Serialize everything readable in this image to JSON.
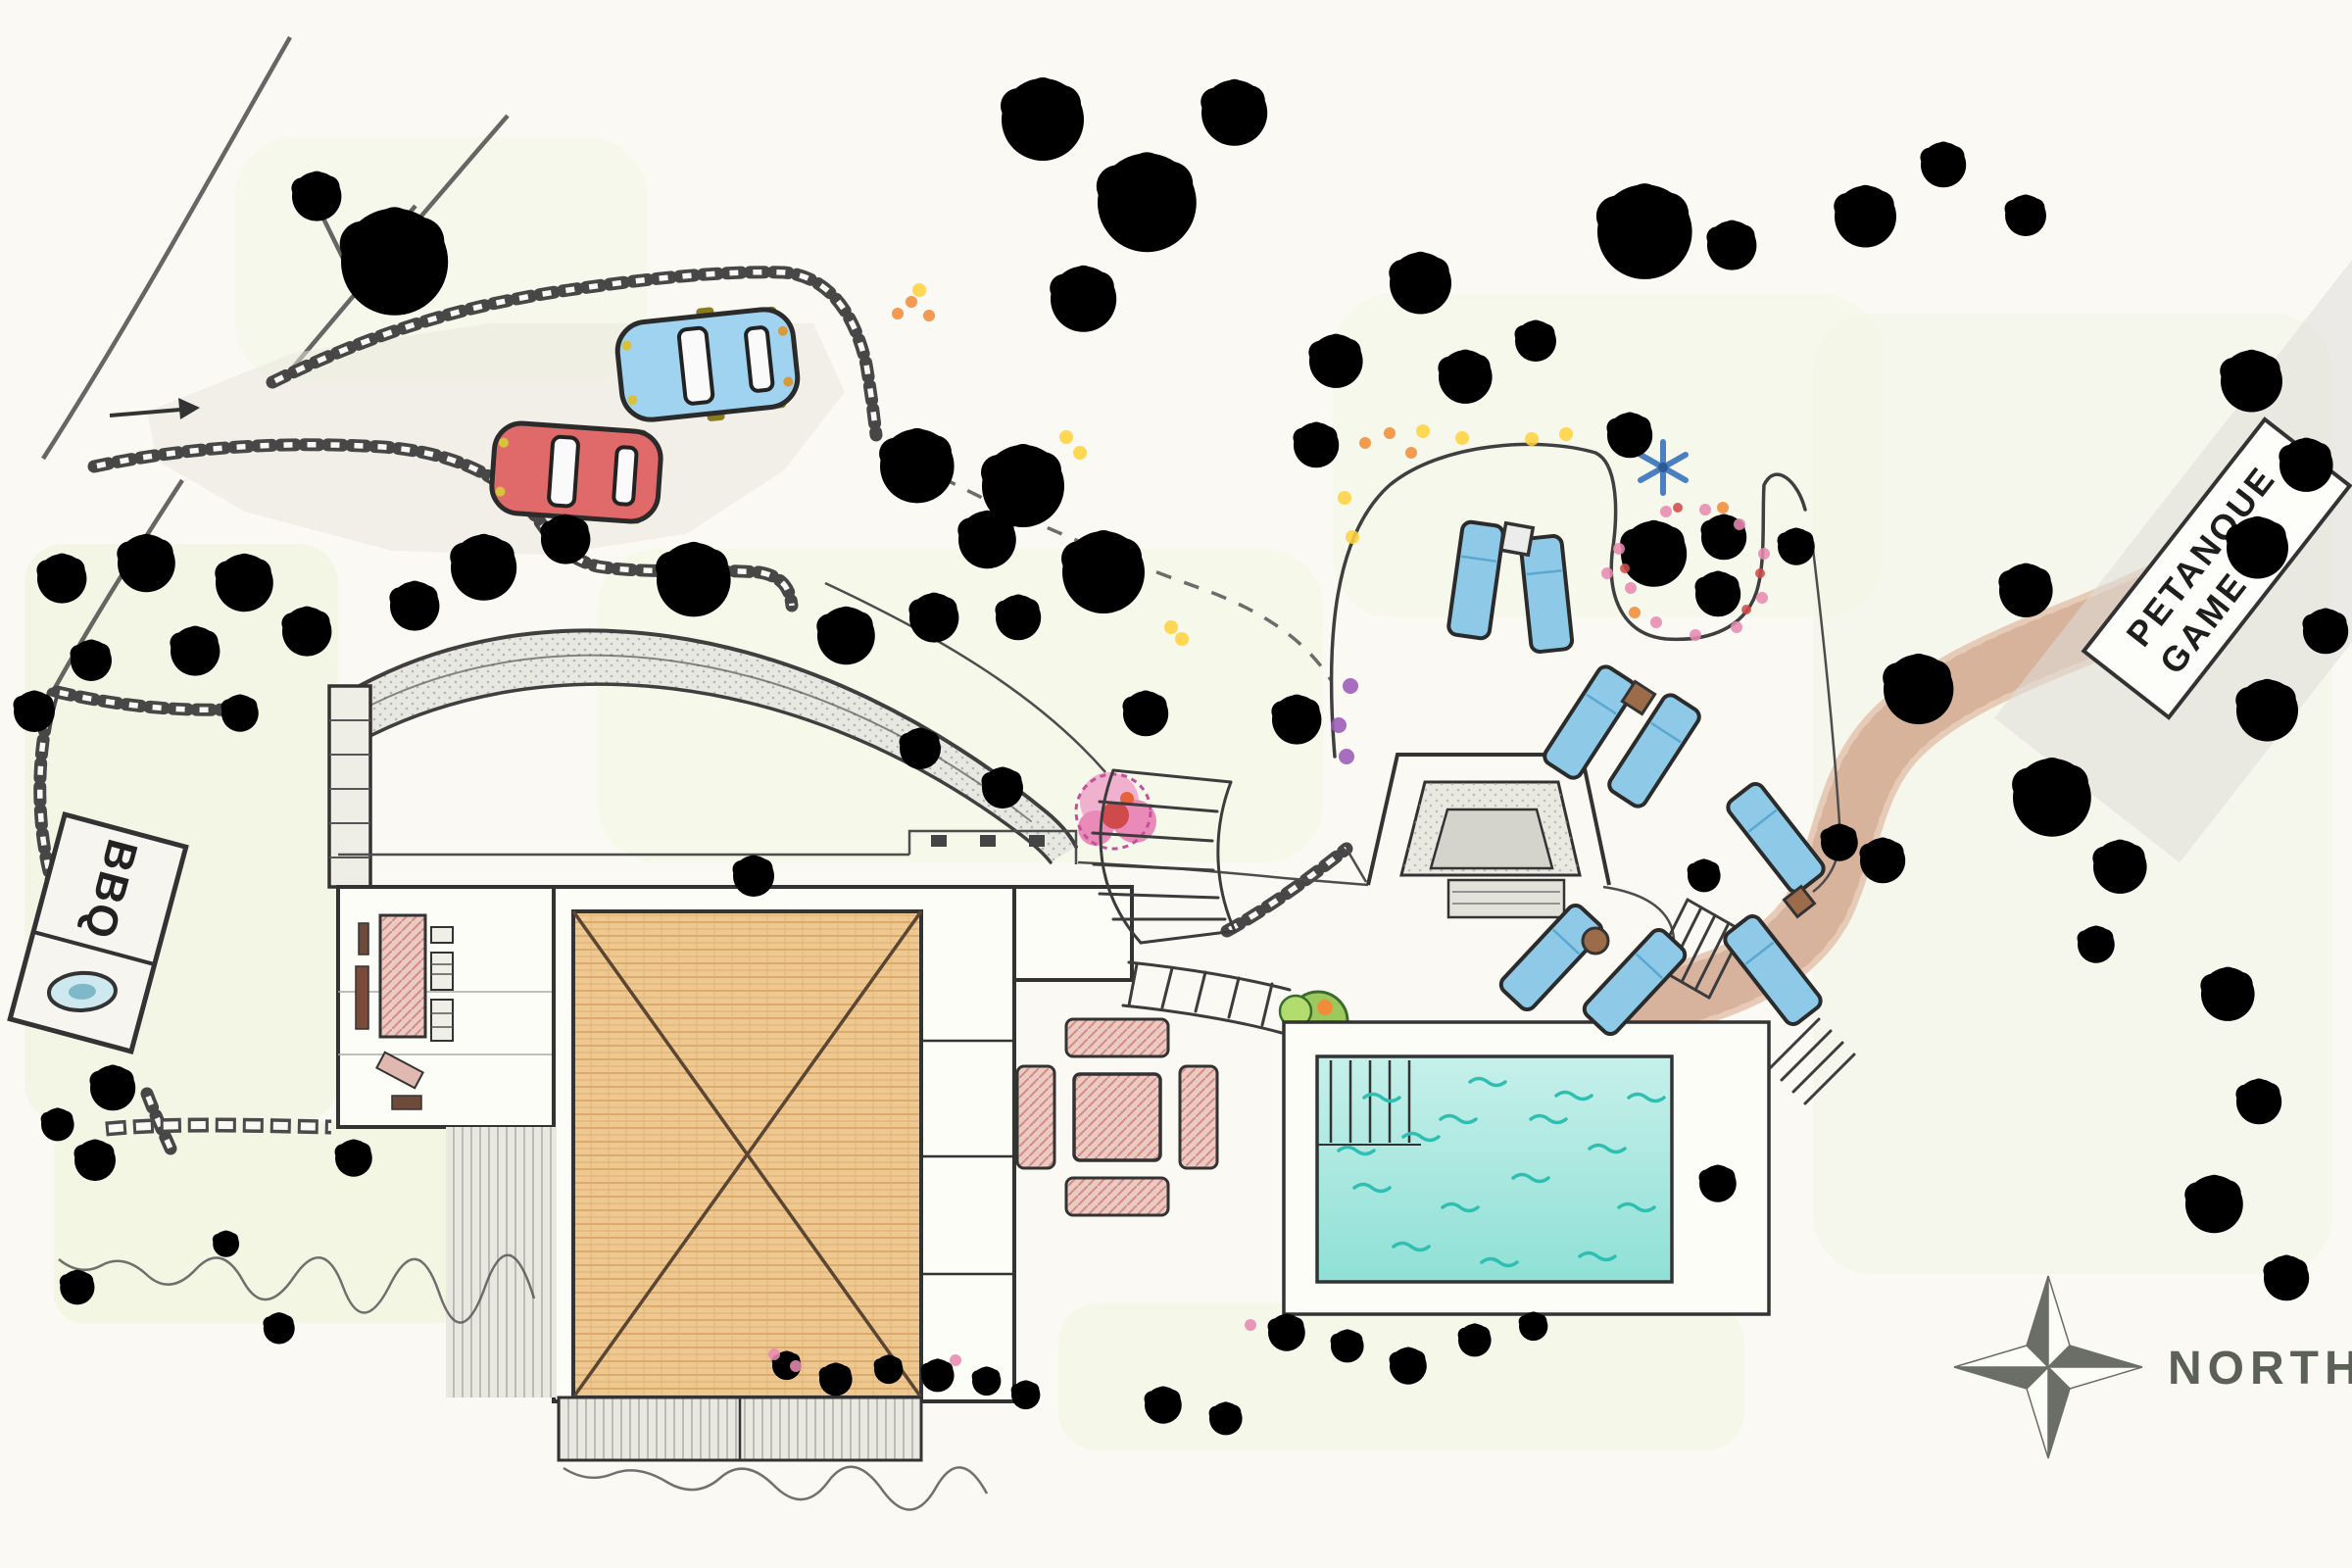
{
  "labels": {
    "bbq": "BBQ",
    "petanque_line1": "PETANQUE",
    "petanque_line2": "GAME",
    "north": "NORTH"
  },
  "colors": {
    "paper": "#faf9f3",
    "ink": "#3f3f3f",
    "tree-dark": "#5fa344",
    "tree-med": "#86c653",
    "tree-light": "#b3dc6e",
    "bush-lime": "#cce977",
    "tree-stroke": "#3c6b2e",
    "halo": "#d9ef9c",
    "lawn": "#edf4d8",
    "roof-fill": "#edc891",
    "roof-line": "#d9a05f",
    "pool-water-1": "#c6f0ea",
    "pool-water-2": "#8fe0d6",
    "pool-wave": "#2fbfb2",
    "lounger": "#8ecae8",
    "car-blue": "#9fd3f0",
    "car-red": "#e06a6a",
    "car-wheel": "#8a7a22",
    "path-tan": "#e3c3ad",
    "path-tan-dot": "#c79b82",
    "paving": "#dededa",
    "flower-pink": "#e78ab0",
    "flower-red": "#cf4b4b",
    "flower-orange": "#f08c3a",
    "flower-yellow": "#ffd23f",
    "flower-purple": "#9b59b6",
    "flower-blue": "#4a7fc1",
    "compass": "#6a6e66",
    "table-brown": "#9c6b4a"
  },
  "vegetation": [
    [
      400,
      262,
      1.3,
      "d"
    ],
    [
      322,
      198,
      0.6,
      "m"
    ],
    [
      62,
      588,
      0.6,
      "l"
    ],
    [
      148,
      572,
      0.7,
      "m"
    ],
    [
      248,
      592,
      0.7,
      "l"
    ],
    [
      312,
      642,
      0.6,
      "m"
    ],
    [
      198,
      662,
      0.6,
      "m"
    ],
    [
      92,
      672,
      0.5,
      "l"
    ],
    [
      34,
      724,
      0.5,
      "l"
    ],
    [
      244,
      726,
      0.45,
      "b"
    ],
    [
      422,
      616,
      0.6,
      "l"
    ],
    [
      492,
      576,
      0.8,
      "m"
    ],
    [
      576,
      548,
      0.6,
      "l"
    ],
    [
      706,
      588,
      0.9,
      "m"
    ],
    [
      934,
      472,
      0.9,
      "m"
    ],
    [
      1006,
      548,
      0.7,
      "m"
    ],
    [
      1062,
      118,
      1.0,
      "d"
    ],
    [
      1168,
      202,
      1.2,
      "d"
    ],
    [
      1258,
      112,
      0.8,
      "m"
    ],
    [
      1104,
      302,
      0.8,
      "d"
    ],
    [
      1042,
      492,
      1.0,
      "d"
    ],
    [
      1124,
      580,
      1.0,
      "d"
    ],
    [
      862,
      646,
      0.7,
      "l"
    ],
    [
      952,
      628,
      0.6,
      "l"
    ],
    [
      1038,
      628,
      0.55,
      "m"
    ],
    [
      938,
      762,
      0.5,
      "l"
    ],
    [
      1022,
      802,
      0.5,
      "l"
    ],
    [
      768,
      892,
      0.5,
      "m"
    ],
    [
      1168,
      726,
      0.55,
      "m"
    ],
    [
      1322,
      732,
      0.6,
      "m"
    ],
    [
      1448,
      286,
      0.75,
      "m"
    ],
    [
      1494,
      382,
      0.65,
      "m"
    ],
    [
      1362,
      366,
      0.65,
      "d"
    ],
    [
      1342,
      452,
      0.55,
      "l"
    ],
    [
      1566,
      346,
      0.5,
      "l"
    ],
    [
      1676,
      232,
      1.15,
      "d"
    ],
    [
      1766,
      248,
      0.6,
      "l"
    ],
    [
      1662,
      442,
      0.55,
      "l"
    ],
    [
      1832,
      556,
      0.45,
      "l"
    ],
    [
      1758,
      546,
      0.55,
      "m"
    ],
    [
      1902,
      218,
      0.75,
      "m"
    ],
    [
      1982,
      166,
      0.55,
      "l"
    ],
    [
      2066,
      218,
      0.5,
      "l"
    ],
    [
      1686,
      562,
      0.8,
      "m"
    ],
    [
      1752,
      604,
      0.55,
      "m"
    ],
    [
      1956,
      700,
      0.85,
      "l"
    ],
    [
      1920,
      876,
      0.55,
      "d"
    ],
    [
      1876,
      858,
      0.45,
      "m"
    ],
    [
      2066,
      600,
      0.65,
      "m"
    ],
    [
      2092,
      810,
      0.95,
      "m"
    ],
    [
      2162,
      882,
      0.65,
      "m"
    ],
    [
      2138,
      962,
      0.45,
      "l"
    ],
    [
      2296,
      386,
      0.75,
      "l"
    ],
    [
      2352,
      472,
      0.65,
      "m"
    ],
    [
      2302,
      556,
      0.75,
      "l"
    ],
    [
      2372,
      642,
      0.55,
      "l"
    ],
    [
      2312,
      722,
      0.75,
      "l"
    ],
    [
      1738,
      892,
      0.4,
      "l"
    ],
    [
      1752,
      1206,
      0.45,
      "l"
    ],
    [
      2272,
      1012,
      0.65,
      "m"
    ],
    [
      2304,
      1122,
      0.55,
      "l"
    ],
    [
      2258,
      1226,
      0.7,
      "m"
    ],
    [
      2332,
      1302,
      0.55,
      "l"
    ],
    [
      802,
      1392,
      0.35,
      "b"
    ],
    [
      852,
      1406,
      0.4,
      "m"
    ],
    [
      906,
      1396,
      0.35,
      "l"
    ],
    [
      956,
      1402,
      0.4,
      "m"
    ],
    [
      1006,
      1408,
      0.35,
      "d"
    ],
    [
      1046,
      1422,
      0.35,
      "d"
    ],
    [
      1186,
      1432,
      0.45,
      "l"
    ],
    [
      1250,
      1446,
      0.4,
      "m"
    ],
    [
      1312,
      1358,
      0.45,
      "m"
    ],
    [
      1374,
      1372,
      0.4,
      "l"
    ],
    [
      1436,
      1392,
      0.45,
      "m"
    ],
    [
      1504,
      1366,
      0.4,
      "l"
    ],
    [
      1564,
      1352,
      0.35,
      "m"
    ],
    [
      96,
      1182,
      0.5,
      "l"
    ],
    [
      78,
      1312,
      0.42,
      "l"
    ],
    [
      230,
      1268,
      0.32,
      "m"
    ],
    [
      284,
      1354,
      0.38,
      "l"
    ],
    [
      360,
      1180,
      0.45,
      "m"
    ],
    [
      114,
      1108,
      0.55,
      "d"
    ],
    [
      58,
      1146,
      0.4,
      "l"
    ]
  ],
  "pool_waves": [
    [
      1392,
      1120
    ],
    [
      1500,
      1104
    ],
    [
      1432,
      1160
    ],
    [
      1562,
      1142
    ],
    [
      1622,
      1172
    ],
    [
      1382,
      1212
    ],
    [
      1472,
      1232
    ],
    [
      1544,
      1202
    ],
    [
      1652,
      1232
    ],
    [
      1422,
      1272
    ],
    [
      1512,
      1288
    ],
    [
      1612,
      1282
    ],
    [
      1662,
      1120
    ],
    [
      1366,
      1174
    ],
    [
      1588,
      1118
    ],
    [
      1470,
      1142
    ]
  ],
  "flower_dots": {
    "pink": [
      [
        1652,
        560
      ],
      [
        1664,
        600
      ],
      [
        1690,
        635
      ],
      [
        1730,
        648
      ],
      [
        1772,
        640
      ],
      [
        1798,
        610
      ],
      [
        1800,
        565
      ],
      [
        1775,
        535
      ],
      [
        1740,
        520
      ],
      [
        1700,
        522
      ],
      [
        790,
        1382
      ],
      [
        812,
        1394
      ],
      [
        975,
        1388
      ],
      [
        1276,
        1352
      ],
      [
        1640,
        585
      ]
    ],
    "red": [
      [
        1658,
        580
      ],
      [
        1782,
        622
      ],
      [
        1712,
        518
      ],
      [
        1796,
        585
      ]
    ],
    "orange": [
      [
        1668,
        625
      ],
      [
        1758,
        518
      ],
      [
        1418,
        442
      ],
      [
        1440,
        462
      ],
      [
        1393,
        452
      ],
      [
        930,
        308
      ],
      [
        948,
        322
      ],
      [
        916,
        320
      ]
    ],
    "yellow": [
      [
        1452,
        440
      ],
      [
        1492,
        447
      ],
      [
        1563,
        448
      ],
      [
        1598,
        443
      ],
      [
        1088,
        446
      ],
      [
        1102,
        462
      ],
      [
        938,
        296
      ],
      [
        1372,
        508
      ],
      [
        1380,
        548
      ],
      [
        1195,
        640
      ],
      [
        1206,
        652
      ]
    ],
    "purple": [
      [
        1378,
        700
      ],
      [
        1366,
        740
      ],
      [
        1374,
        772
      ]
    ]
  }
}
